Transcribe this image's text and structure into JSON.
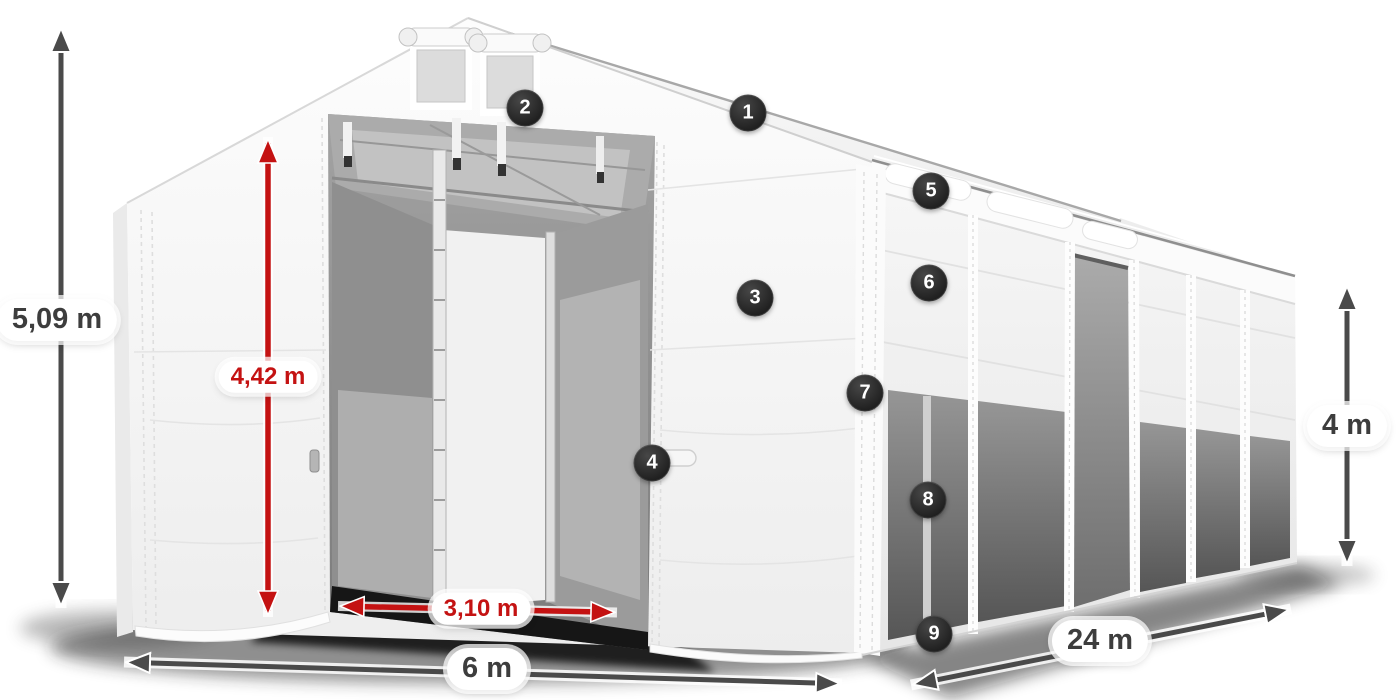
{
  "diagram": {
    "subject": "storage-tent-with-dimensions",
    "background": "#ffffff"
  },
  "colors": {
    "dimension_gray": "#4a4a4a",
    "dimension_red": "#c41212",
    "badge_background": "#282828",
    "badge_text": "#ffffff",
    "pill_background": "#ffffff",
    "tent_fabric": "#f4f4f4",
    "interior_shade": "#8d8d8d"
  },
  "dimensions": {
    "total_height": {
      "label": "5,09 m",
      "orientation": "vertical",
      "color": "gray"
    },
    "inner_height": {
      "label": "4,42 m",
      "orientation": "vertical",
      "color": "red"
    },
    "inner_door_width": {
      "label": "3,10 m",
      "orientation": "horizontal",
      "color": "red"
    },
    "front_width": {
      "label": "6 m",
      "orientation": "horizontal",
      "color": "gray"
    },
    "side_length": {
      "label": "24 m",
      "orientation": "diagonal",
      "color": "gray"
    },
    "side_height": {
      "label": "4 m",
      "orientation": "vertical",
      "color": "gray"
    }
  },
  "markers": [
    {
      "number": "1"
    },
    {
      "number": "2"
    },
    {
      "number": "3"
    },
    {
      "number": "4"
    },
    {
      "number": "5"
    },
    {
      "number": "6"
    },
    {
      "number": "7"
    },
    {
      "number": "8"
    },
    {
      "number": "9"
    }
  ]
}
